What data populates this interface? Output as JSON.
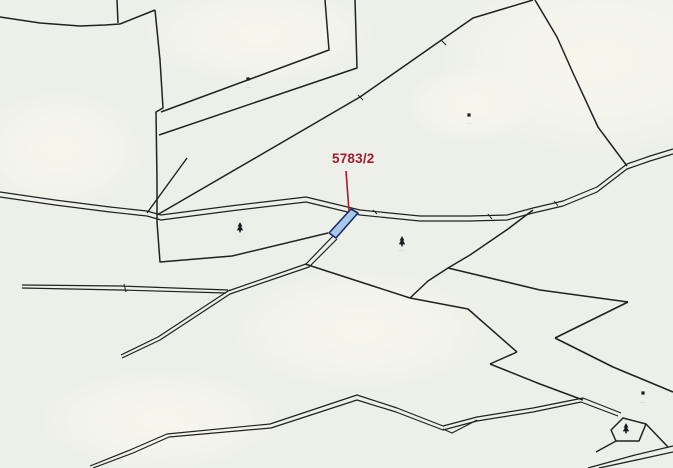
{
  "canvas": {
    "width": 673,
    "height": 468,
    "background": "#edf0e9"
  },
  "palette": {
    "boundary_line": "#212121",
    "road_line": "#262626",
    "highlight_fill": "#a9c7e6",
    "highlight_border": "#1c2a6d",
    "label_red": "#a31c2e",
    "micro_text": "#8f948b",
    "patch": "#f8f7ec",
    "symbol": "#1c1c1c"
  },
  "highlight": {
    "label": "5783/2",
    "leader": [
      [
        346,
        171
      ],
      [
        349,
        211
      ]
    ],
    "polygon": [
      [
        351,
        209
      ],
      [
        358,
        213
      ],
      [
        336,
        238
      ],
      [
        329,
        233
      ]
    ]
  },
  "patches": [
    {
      "cx": 600,
      "cy": 60,
      "rx": 160,
      "ry": 95
    },
    {
      "cx": 260,
      "cy": 35,
      "rx": 115,
      "ry": 48
    },
    {
      "cx": 470,
      "cy": 105,
      "rx": 65,
      "ry": 38
    },
    {
      "cx": 360,
      "cy": 330,
      "rx": 130,
      "ry": 60
    },
    {
      "cx": 60,
      "cy": 150,
      "rx": 85,
      "ry": 60
    },
    {
      "cx": 160,
      "cy": 420,
      "rx": 120,
      "ry": 50
    }
  ],
  "polylines": [
    {
      "name": "boundary-topleft-wavy",
      "w": 1.5,
      "pts": [
        [
          0,
          17
        ],
        [
          40,
          23
        ],
        [
          80,
          26
        ],
        [
          105,
          25
        ],
        [
          120,
          24
        ]
      ]
    },
    {
      "name": "boundary-topleft-hook",
      "w": 1.5,
      "pts": [
        [
          120,
          24
        ],
        [
          155,
          10
        ]
      ]
    },
    {
      "name": "boundary-top-vertical",
      "w": 1.5,
      "pts": [
        [
          117,
          0
        ],
        [
          118,
          23
        ]
      ]
    },
    {
      "name": "boundary-west-descent",
      "w": 1.5,
      "pts": [
        [
          155,
          10
        ],
        [
          160,
          60
        ],
        [
          163,
          108
        ],
        [
          156,
          112
        ],
        [
          157,
          180
        ],
        [
          157,
          222
        ]
      ]
    },
    {
      "name": "boundary-strip-1",
      "w": 1.5,
      "pts": [
        [
          325,
          0
        ],
        [
          329,
          50
        ],
        [
          161,
          112
        ]
      ]
    },
    {
      "name": "boundary-strip-2",
      "w": 1.5,
      "pts": [
        [
          355,
          0
        ],
        [
          357,
          68
        ],
        [
          159,
          135
        ]
      ]
    },
    {
      "name": "boundary-strip-long",
      "w": 1.5,
      "pts": [
        [
          533,
          0
        ],
        [
          473,
          18
        ],
        [
          360,
          97
        ],
        [
          257,
          157
        ],
        [
          157,
          215
        ]
      ]
    },
    {
      "name": "boundary-strip-short",
      "w": 1.4,
      "pts": [
        [
          147,
          213
        ],
        [
          187,
          158
        ]
      ]
    },
    {
      "name": "boundary-upper-right",
      "w": 1.5,
      "pts": [
        [
          535,
          0
        ],
        [
          557,
          37
        ],
        [
          573,
          73
        ],
        [
          598,
          127
        ],
        [
          627,
          166
        ]
      ]
    },
    {
      "name": "boundary-below-road-west",
      "w": 1.5,
      "pts": [
        [
          157,
          222
        ],
        [
          160,
          262
        ],
        [
          232,
          256
        ],
        [
          328,
          233
        ]
      ]
    },
    {
      "name": "boundary-below-road-diag",
      "w": 1.5,
      "pts": [
        [
          305,
          264
        ],
        [
          410,
          298
        ]
      ]
    },
    {
      "name": "boundary-curve-from-road",
      "w": 1.5,
      "pts": [
        [
          533,
          210
        ],
        [
          508,
          229
        ],
        [
          470,
          255
        ],
        [
          448,
          268
        ]
      ]
    },
    {
      "name": "boundary-zig-east-1",
      "w": 1.6,
      "pts": [
        [
          448,
          268
        ],
        [
          540,
          290
        ],
        [
          628,
          302
        ]
      ]
    },
    {
      "name": "boundary-zig-east-2",
      "w": 1.6,
      "pts": [
        [
          628,
          302
        ],
        [
          555,
          338
        ]
      ]
    },
    {
      "name": "boundary-zig-east-3",
      "w": 1.6,
      "pts": [
        [
          555,
          338
        ],
        [
          613,
          367
        ],
        [
          673,
          392
        ]
      ]
    },
    {
      "name": "boundary-zig-west",
      "w": 1.5,
      "pts": [
        [
          448,
          268
        ],
        [
          428,
          281
        ],
        [
          410,
          298
        ]
      ]
    },
    {
      "name": "boundary-mid-diag-1",
      "w": 1.5,
      "pts": [
        [
          410,
          298
        ],
        [
          468,
          309
        ],
        [
          517,
          352
        ]
      ]
    },
    {
      "name": "boundary-mid-diag-2",
      "w": 1.5,
      "pts": [
        [
          517,
          352
        ],
        [
          490,
          364
        ]
      ]
    },
    {
      "name": "boundary-mid-diag-3",
      "w": 1.5,
      "pts": [
        [
          490,
          364
        ],
        [
          540,
          384
        ],
        [
          583,
          400
        ]
      ]
    },
    {
      "name": "road-upper-edge",
      "w": 1.2,
      "pts": [
        [
          0,
          192
        ],
        [
          55,
          200
        ],
        [
          110,
          207
        ],
        [
          147,
          211
        ],
        [
          161,
          215
        ],
        [
          230,
          206
        ],
        [
          306,
          197
        ],
        [
          360,
          210
        ],
        [
          420,
          216
        ],
        [
          470,
          216
        ],
        [
          507,
          215
        ],
        [
          533,
          208
        ],
        [
          563,
          201
        ],
        [
          597,
          187
        ],
        [
          627,
          164
        ],
        [
          650,
          156
        ],
        [
          673,
          149
        ]
      ]
    },
    {
      "name": "road-lower-edge",
      "w": 1.2,
      "pts": [
        [
          0,
          197
        ],
        [
          55,
          205
        ],
        [
          110,
          212
        ],
        [
          147,
          216
        ],
        [
          161,
          220
        ],
        [
          230,
          211
        ],
        [
          306,
          202
        ],
        [
          360,
          215
        ],
        [
          420,
          221
        ],
        [
          470,
          221
        ],
        [
          507,
          220
        ],
        [
          533,
          213
        ],
        [
          563,
          206
        ],
        [
          597,
          192
        ],
        [
          627,
          169
        ],
        [
          650,
          161
        ],
        [
          673,
          154
        ]
      ]
    },
    {
      "name": "track-nw-upper",
      "w": 1.2,
      "pts": [
        [
          333,
          236
        ],
        [
          306,
          264
        ],
        [
          228,
          291
        ],
        [
          158,
          337
        ],
        [
          121,
          355
        ]
      ]
    },
    {
      "name": "track-nw-lower",
      "w": 1.2,
      "pts": [
        [
          337,
          239
        ],
        [
          309,
          267
        ],
        [
          230,
          294
        ],
        [
          160,
          340
        ],
        [
          122,
          358
        ]
      ]
    },
    {
      "name": "sliver-upper",
      "w": 1.2,
      "pts": [
        [
          22,
          285
        ],
        [
          120,
          286
        ],
        [
          228,
          290
        ]
      ]
    },
    {
      "name": "sliver-lower",
      "w": 1.2,
      "pts": [
        [
          22,
          288
        ],
        [
          120,
          290
        ],
        [
          226,
          293
        ]
      ]
    },
    {
      "name": "sliver-tick",
      "w": 1.0,
      "pts": [
        [
          124,
          284
        ],
        [
          126,
          292
        ]
      ]
    },
    {
      "name": "track-south-upper",
      "w": 1.2,
      "pts": [
        [
          90,
          466
        ],
        [
          130,
          450
        ],
        [
          167,
          434
        ],
        [
          270,
          424
        ],
        [
          357,
          395
        ],
        [
          397,
          408
        ],
        [
          443,
          426
        ],
        [
          477,
          417
        ],
        [
          533,
          408
        ],
        [
          583,
          398
        ],
        [
          621,
          413
        ]
      ]
    },
    {
      "name": "track-south-lower",
      "w": 1.2,
      "pts": [
        [
          93,
          468
        ],
        [
          133,
          453
        ],
        [
          169,
          437
        ],
        [
          271,
          428
        ],
        [
          357,
          400
        ],
        [
          396,
          412
        ],
        [
          443,
          430
        ],
        [
          477,
          421
        ],
        [
          533,
          412
        ],
        [
          581,
          402
        ],
        [
          618,
          416
        ]
      ]
    },
    {
      "name": "track-south-fork",
      "w": 1.2,
      "pts": [
        [
          477,
          420
        ],
        [
          452,
          433
        ],
        [
          443,
          429
        ]
      ]
    },
    {
      "name": "quad-exit-east",
      "w": 1.5,
      "pts": [
        [
          646,
          424
        ],
        [
          668,
          447
        ]
      ]
    },
    {
      "name": "quad-exit-west",
      "w": 1.4,
      "pts": [
        [
          616,
          441
        ],
        [
          596,
          452
        ]
      ]
    },
    {
      "name": "corner-track-upper",
      "w": 1.3,
      "pts": [
        [
          588,
          468
        ],
        [
          635,
          455
        ],
        [
          673,
          446
        ]
      ]
    },
    {
      "name": "corner-track-lower",
      "w": 1.3,
      "pts": [
        [
          599,
          468
        ],
        [
          641,
          459
        ],
        [
          673,
          452
        ]
      ]
    },
    {
      "name": "road-tick-1",
      "w": 1.0,
      "pts": [
        [
          373,
          210
        ],
        [
          377,
          214
        ]
      ]
    },
    {
      "name": "road-tick-2",
      "w": 1.0,
      "pts": [
        [
          488,
          214
        ],
        [
          492,
          219
        ]
      ]
    },
    {
      "name": "road-tick-3",
      "w": 1.0,
      "pts": [
        [
          554,
          201
        ],
        [
          558,
          206
        ]
      ]
    },
    {
      "name": "strip-tick-1",
      "w": 1.0,
      "pts": [
        [
          441,
          40
        ],
        [
          446,
          45
        ]
      ]
    },
    {
      "name": "strip-tick-2",
      "w": 1.0,
      "pts": [
        [
          358,
          95
        ],
        [
          363,
          100
        ]
      ]
    }
  ],
  "polygons": [
    {
      "name": "small-parcel-quad",
      "pts": [
        [
          611,
          430
        ],
        [
          623,
          418
        ],
        [
          646,
          424
        ],
        [
          639,
          441
        ],
        [
          616,
          441
        ]
      ]
    }
  ],
  "trees": [
    [
      240,
      227
    ],
    [
      402,
      241
    ],
    [
      626,
      428
    ]
  ],
  "dots": [
    [
      248,
      79
    ],
    [
      469,
      115
    ],
    [
      643,
      393
    ]
  ],
  "micro_labels": [
    {
      "x": 240,
      "y": 238,
      "text": "····"
    },
    {
      "x": 402,
      "y": 252,
      "text": "····"
    },
    {
      "x": 248,
      "y": 89,
      "text": "····"
    },
    {
      "x": 469,
      "y": 125,
      "text": "····"
    },
    {
      "x": 643,
      "y": 404,
      "text": "····"
    }
  ]
}
